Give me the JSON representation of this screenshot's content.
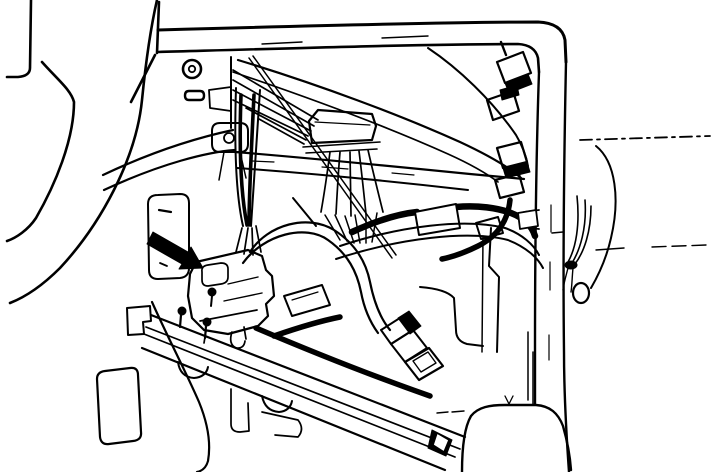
{
  "figure": {
    "title": "Under-dash wiring harness and connector location illustration (service-manual line art); black arrow indicates the main connector beside the lower dash opening",
    "type": "technical-line-illustration",
    "background": "#ffffff",
    "ink": "#000000",
    "arrow_color": "#000000",
    "elements": [
      {
        "n": "dash-top-bar-upper-edge",
        "t": "p",
        "d": "M158,30 C300,26 450,22 538,22 Q562,23 565,40 L566,62",
        "w": 3
      },
      {
        "n": "dash-top-bar-lower-edge",
        "t": "p",
        "d": "M158,52 C300,48 430,44 518,44 Q535,45 538,58 L539,72",
        "w": 2.6
      },
      {
        "n": "dash-top-bar-left-post",
        "t": "p",
        "d": "M159,2 L157,53 M155,55 L131,102",
        "w": 2.6
      },
      {
        "n": "dash-top-bar-tick-1",
        "t": "p",
        "d": "M262,44 L302,42",
        "w": 1.4
      },
      {
        "n": "dash-top-bar-tick-2",
        "t": "p",
        "d": "M382,38 L428,36",
        "w": 1.4
      },
      {
        "n": "a-pillar-left-edge",
        "t": "p",
        "d": "M539,72 C536,160 535,260 535,348 L535,404",
        "w": 2.4
      },
      {
        "n": "a-pillar-right-edge",
        "t": "p",
        "d": "M566,62 C564,160 563,270 564,352 C564,395 566,430 569,472",
        "w": 2.4
      },
      {
        "n": "a-pillar-dash-marks",
        "t": "p",
        "d": "M551,205 L551,232 M550,262 L550,290 M549,335 L549,360",
        "w": 1.2
      },
      {
        "n": "pillar-step-bracket",
        "t": "p",
        "d": "M539,210 L524,212 L523,227 L539,229",
        "w": 1.8
      },
      {
        "n": "door-sill-line",
        "t": "p",
        "d": "M580,140 L710,136",
        "w": 1.8,
        "da": "12 5 3 5"
      },
      {
        "n": "seat-contour-line-short",
        "t": "p",
        "d": "M596,250 L624,248",
        "w": 1.4
      },
      {
        "n": "seat-contour-line-long",
        "t": "p",
        "d": "M652,247 L706,245",
        "w": 1.4,
        "da": "14 6"
      },
      {
        "n": "door-panel-curve",
        "t": "p",
        "d": "M596,146 C616,162 620,200 611,238 C606,260 598,276 591,288",
        "w": 2
      },
      {
        "n": "floor-hump-contour",
        "t": "p",
        "d": "M462,472 C462,448 464,428 471,416 C478,407 490,405 505,405 L536,405 C550,406 558,413 563,426 C567,440 570,456 571,470",
        "w": 2.4
      },
      {
        "n": "floor-hump-dash-marks",
        "t": "p",
        "d": "M437,413 L448,412 M452,412 L464,411",
        "w": 1.4
      },
      {
        "n": "heater-lower-vertical",
        "t": "p",
        "d": "M533,352 L533,404 M528,332 L528,400",
        "w": 1.5
      },
      {
        "n": "floor-vee-mark",
        "t": "p",
        "d": "M505,396 L509,404 L513,396",
        "w": 1.3
      },
      {
        "n": "steering-wheel-rim",
        "t": "p",
        "d": "M31,0 L30,68 Q30,76 18,77 L7,77",
        "w": 2.6
      },
      {
        "n": "steering-column-front-edge",
        "t": "p",
        "d": "M42,62 C58,80 71,90 74,102 C74,140 55,185 36,218 C28,230 16,238 7,241",
        "w": 2.6
      },
      {
        "n": "steering-column-rear-edge",
        "t": "p",
        "d": "M157,0 C149,35 145,70 142,100 C136,160 100,225 60,268 C45,283 28,296 10,303",
        "w": 2.6
      },
      {
        "n": "panel-screw-outer",
        "t": "c",
        "cx": 192,
        "cy": 69,
        "r": 9,
        "w": 2.6
      },
      {
        "n": "panel-screw-inner",
        "t": "c",
        "cx": 192,
        "cy": 69,
        "r": 3.2,
        "w": 1.8
      },
      {
        "n": "panel-slot",
        "t": "p",
        "d": "M189,91 L200,91 Q204,91 204,95.5 Q204,100 200,100 L189,100 Q185,100 185,95.5 Q185,91 189,91 Z",
        "w": 2.4
      },
      {
        "n": "panel-edge-vertical",
        "t": "p",
        "d": "M231,57 L231,128",
        "w": 2
      },
      {
        "n": "panel-bracket-tab",
        "t": "p",
        "d": "M231,87 L209,90 L210,108 L231,111",
        "w": 1.8
      },
      {
        "n": "panel-mount-boss",
        "t": "p",
        "d": "M220,123 L240,123 Q248,123 248,131 L248,144 Q248,152 240,152 L220,152 Q212,152 212,144 L212,131 Q212,123 220,123 Z",
        "w": 2
      },
      {
        "n": "panel-mount-hole",
        "t": "c",
        "cx": 229,
        "cy": 138,
        "r": 5,
        "w": 1.8
      },
      {
        "n": "panel-mount-stems",
        "t": "p",
        "d": "M224,152 L219,180 M240,152 L246,178",
        "w": 1.5
      },
      {
        "n": "column-support-band-upper",
        "t": "p",
        "d": "M103,175 C160,148 205,136 233,130",
        "w": 2.2
      },
      {
        "n": "column-support-band-lower",
        "t": "p",
        "d": "M104,190 C162,163 208,152 235,150",
        "w": 2.2
      },
      {
        "n": "crossmember-top-edge",
        "t": "p",
        "d": "M235,152 C310,158 390,166 470,174 L524,179",
        "w": 2.2
      },
      {
        "n": "crossmember-bottom-edge",
        "t": "p",
        "d": "M237,168 C305,173 390,181 468,190",
        "w": 2
      },
      {
        "n": "crossmember-dash-marks",
        "t": "p",
        "d": "M252,161 L274,162 M322,167 L348,169 M392,173 L414,175",
        "w": 1.2
      },
      {
        "n": "wire-fan-behind-panel",
        "t": "p",
        "d": "M233,70 L318,120 M233,80 L314,126 M233,90 L311,131 M233,100 L308,136 M246,108 L306,140 M259,119 L304,144",
        "w": 1.7
      },
      {
        "n": "harness-branch-upper-right-a",
        "t": "p",
        "d": "M238,60 C320,85 400,115 460,142 C490,156 510,168 521,178",
        "w": 2.2
      },
      {
        "n": "harness-branch-upper-right-b",
        "t": "p",
        "d": "M233,72 C310,98 390,128 448,154 C468,163 486,173 498,182",
        "w": 1.7
      },
      {
        "n": "antenna-rod",
        "t": "p",
        "d": "M249,58 L392,258 M253,56 L396,255",
        "w": 1.5
      },
      {
        "n": "glovebox-inner-curve",
        "t": "p",
        "d": "M428,48 C458,68 492,100 516,135 C522,145 526,155 528,166",
        "w": 2
      },
      {
        "n": "panel-lower-diagonal",
        "t": "p",
        "d": "M293,198 L316,226",
        "w": 2
      },
      {
        "n": "junction-connector-body",
        "t": "p",
        "d": "M309,121 L318,110 L372,114 L376,126 L372,140 L312,143 Z",
        "w": 2.2
      },
      {
        "n": "junction-connector-ridge",
        "t": "p",
        "d": "M315,122 L370,125",
        "w": 1.2
      },
      {
        "n": "junction-connector-flange",
        "t": "p",
        "d": "M303,147 L380,142 M306,153 L377,149",
        "w": 1.6
      },
      {
        "n": "junction-wire-fan",
        "t": "p",
        "d": "M330,152 C327,175 324,195 321,212 M340,152 C338,176 337,196 336,214 M350,152 L351,216 M359,151 C362,175 364,195 366,214 M368,150 C373,172 378,192 383,212",
        "w": 1.7
      },
      {
        "n": "junction-wire-strands",
        "t": "p",
        "d": "M325,215 L340,240 M335,215 L347,241 M345,216 L354,243 M355,215 L360,243 M366,214 L366,243 M377,213 L372,242",
        "w": 1.5
      },
      {
        "n": "harness-tape-arc-left",
        "t": "p",
        "d": "M352,232 C378,220 398,214 417,212",
        "w": 6.5
      },
      {
        "n": "harness-tape-arc-right",
        "t": "p",
        "d": "M456,207 C478,205 498,208 511,213 C524,218 532,226 535,236",
        "w": 6.5
      },
      {
        "n": "harness-tape-patch",
        "t": "p",
        "d": "M415,212 L456,204 L460,228 L419,235 Z",
        "w": 2,
        "f": "#ffffff"
      },
      {
        "n": "harness-tape-end-clip",
        "t": "p",
        "d": "M518,213 L536,210 L538,226 L520,229 Z",
        "w": 1.8,
        "f": "#ffffff"
      },
      {
        "n": "harness-band-upper-edge",
        "t": "p",
        "d": "M340,246 C400,226 465,218 505,228 C522,234 534,245 539,255",
        "w": 2
      },
      {
        "n": "harness-band-lower-edge",
        "t": "p",
        "d": "M336,259 C400,238 468,230 508,240 C526,247 538,258 543,268",
        "w": 2
      },
      {
        "n": "harness-loop-outer",
        "t": "p",
        "d": "M250,252 C268,224 308,214 334,230 C356,244 366,262 370,282 C374,302 380,318 390,330",
        "w": 2.2
      },
      {
        "n": "harness-loop-inner",
        "t": "p",
        "d": "M243,263 C264,234 306,224 328,240 C348,254 357,272 361,292 C364,308 370,322 378,333",
        "w": 2.2
      },
      {
        "n": "hanging-connector-collar",
        "t": "p",
        "d": "M398,318 L409,311 L421,326 L410,334 Z",
        "w": 1,
        "f": "#000000"
      },
      {
        "n": "hanging-connector-band-1",
        "t": "p",
        "d": "M381,330 L403,316 L413,330 L391,344 Z",
        "w": 2
      },
      {
        "n": "hanging-connector-band-2",
        "t": "p",
        "d": "M391,344 L413,330 L427,348 L405,362 Z",
        "w": 2
      },
      {
        "n": "hanging-connector-tip-outer",
        "t": "p",
        "d": "M405,362 L429,348 L443,366 L419,380 Z",
        "w": 2.2
      },
      {
        "n": "hanging-connector-tip-inner",
        "t": "p",
        "d": "M413,361 L428,352 L436,363 L421,372 Z",
        "w": 1.4
      },
      {
        "n": "heater-right-edge",
        "t": "p",
        "d": "M491,228 L489,266 L499,277 L497,352",
        "w": 2
      },
      {
        "n": "heater-inner-vertical",
        "t": "p",
        "d": "M483,236 L482,352",
        "w": 1.5
      },
      {
        "n": "heater-corner-panel",
        "t": "p",
        "d": "M420,287 Q446,289 454,298 L456,330 Q456,341 467,344 L483,346",
        "w": 2
      },
      {
        "n": "inline-connector-1",
        "t": "p",
        "d": "M497,62 L523,52 L531,73 L505,83 Z",
        "w": 2.2
      },
      {
        "n": "inline-connector-1-link",
        "t": "p",
        "d": "M505,83 L528,74 L532,84 L509,93 Z",
        "w": 1,
        "f": "#000000"
      },
      {
        "n": "inline-connector-2",
        "t": "p",
        "d": "M487,100 L513,91 L519,111 L493,120 Z",
        "w": 2.2
      },
      {
        "n": "inline-connector-2-link",
        "t": "p",
        "d": "M500,90 L517,85 L519,95 L502,100 Z",
        "w": 1,
        "f": "#000000"
      },
      {
        "n": "inline-connector-3",
        "t": "p",
        "d": "M497,148 L521,142 L527,162 L503,168 Z",
        "w": 2.2
      },
      {
        "n": "inline-connector-3-link",
        "t": "p",
        "d": "M503,168 L527,162 L530,172 L506,178 Z",
        "w": 1,
        "f": "#000000"
      },
      {
        "n": "inline-connector-4",
        "t": "p",
        "d": "M495,180 L519,174 L524,192 L500,198 Z",
        "w": 2.2
      },
      {
        "n": "inline-connector-5",
        "t": "p",
        "d": "M476,223 L498,217 L503,233 L481,239 Z",
        "w": 2
      },
      {
        "n": "inline-connector-neck",
        "t": "p",
        "d": "M506,55 L501,42",
        "w": 2.4
      },
      {
        "n": "chain-harness-tail",
        "t": "p",
        "d": "M510,200 C508,220 498,236 478,246 C464,253 452,257 442,259",
        "w": 5.5
      },
      {
        "n": "pillar-wire-strands",
        "t": "p",
        "d": "M577,196 C580,225 576,248 568,262 M585,200 C587,228 580,250 572,263 M591,206 C591,232 584,252 575,264",
        "w": 1.6
      },
      {
        "n": "pillar-wire-knot",
        "t": "e",
        "cx": 571,
        "cy": 265,
        "rx": 6,
        "ry": 4,
        "w": 1,
        "f": "#000000"
      },
      {
        "n": "pillar-wire-tails",
        "t": "p",
        "d": "M568,268 C566,276 564,282 563,290 M573,268 C572,278 572,286 571,292",
        "w": 1.4
      },
      {
        "n": "pillar-wire-loop",
        "t": "e",
        "cx": 581,
        "cy": 293,
        "rx": 8,
        "ry": 10,
        "w": 2.2
      },
      {
        "n": "pillar-wire-tick",
        "t": "p",
        "d": "M552,233 L563,232",
        "w": 1.5
      },
      {
        "n": "lower-dash-opening",
        "t": "p",
        "d": "M158,195 L180,194 Q189,194 189,203 L189,268 Q189,277 180,278 L158,279 Q149,279 149,270 L148,204 Q148,195 158,195 Z",
        "w": 2
      },
      {
        "n": "opening-mark-1",
        "t": "p",
        "d": "M159,210 L171,212",
        "w": 2.2
      },
      {
        "n": "opening-mark-2",
        "t": "p",
        "d": "M160,263 L167,266",
        "w": 1.8
      },
      {
        "n": "pointer-arrow",
        "t": "p",
        "d": "M153,232 L188,252 L191,247 L203,268 L179,269 L182,264 L147,244 Z",
        "w": 1,
        "f": "#000000"
      },
      {
        "n": "main-bundle-left-edge",
        "t": "p",
        "d": "M236,88 C234,150 236,195 243,226",
        "w": 2
      },
      {
        "n": "main-bundle-right-edge",
        "t": "p",
        "d": "M260,90 C256,155 253,198 251,226",
        "w": 2
      },
      {
        "n": "main-bundle-core",
        "t": "p",
        "d": "M241,95 C239,150 241,195 247,225 M254,95 C251,155 249,198 249,225",
        "w": 3.6
      },
      {
        "n": "main-bundle-strands",
        "t": "p",
        "d": "M242,228 L236,252 M248,228 L244,254 M252,228 L253,255 M256,226 L261,252",
        "w": 1.7
      },
      {
        "n": "main-connector-outline",
        "t": "p",
        "d": "M196,262 L248,250 L262,256 L266,270 L272,276 L274,296 L266,304 L268,316 L258,326 L228,334 L204,330 L192,318 L188,296 L190,274 Z",
        "w": 2.2
      },
      {
        "n": "main-connector-latch",
        "t": "p",
        "d": "M202,272 Q201,266 208,265 L221,263 Q228,263 228,269 L228,277 Q228,283 221,284 L208,286 Q202,286 202,280 Z",
        "w": 1.7
      },
      {
        "n": "main-connector-pin",
        "t": "c",
        "cx": 212,
        "cy": 292,
        "r": 4,
        "w": 1,
        "f": "#000000"
      },
      {
        "n": "main-connector-pin-stem",
        "t": "p",
        "d": "M212,296 L211,306",
        "w": 2
      },
      {
        "n": "main-connector-ridge-1",
        "t": "p",
        "d": "M228,284 L258,277",
        "w": 1.4
      },
      {
        "n": "main-connector-ridge-2",
        "t": "p",
        "d": "M224,301 L262,293",
        "w": 1.4
      },
      {
        "n": "main-connector-flange",
        "t": "p",
        "d": "M200,321 L257,310",
        "w": 1.7
      },
      {
        "n": "main-connector-tabs",
        "t": "p",
        "d": "M206,331 L204,343 M244,327 L246,339",
        "w": 1.7
      },
      {
        "n": "side-connector-body",
        "t": "p",
        "d": "M284,296 L322,285 L330,305 L292,316 Z",
        "w": 2
      },
      {
        "n": "side-connector-ridge",
        "t": "p",
        "d": "M292,300 L318,292",
        "w": 1.2
      },
      {
        "n": "rail-harness-strip",
        "t": "p",
        "d": "M274,336 C300,327 320,321 340,317",
        "w": 5.5
      },
      {
        "n": "rail-harness-strip-long",
        "t": "p",
        "d": "M256,328 C310,351 370,375 430,396",
        "w": 5.5
      },
      {
        "n": "rail-end-cap",
        "t": "p",
        "d": "M127,308 L150,306 L151,321 L143,322 L144,334 L128,335 Z",
        "w": 2
      },
      {
        "n": "rail-top-edge",
        "t": "p",
        "d": "M151,315 L465,437",
        "w": 2.2
      },
      {
        "n": "rail-stripe-1",
        "t": "p",
        "d": "M146,327 L460,449",
        "w": 1.7
      },
      {
        "n": "rail-stripe-2",
        "t": "p",
        "d": "M144,334 L455,457",
        "w": 1.7
      },
      {
        "n": "rail-bottom-edge",
        "t": "p",
        "d": "M142,348 L445,470",
        "w": 2.2
      },
      {
        "n": "rail-scallop-1",
        "t": "p",
        "d": "M178,362 Q180,377 194,378 Q206,377 208,367",
        "w": 2
      },
      {
        "n": "rail-scallop-2",
        "t": "p",
        "d": "M262,396 Q265,411 279,412 Q290,411 292,401",
        "w": 2
      },
      {
        "n": "rail-stud-1",
        "t": "c",
        "cx": 182,
        "cy": 311,
        "r": 4,
        "w": 1,
        "f": "#000000"
      },
      {
        "n": "rail-stud-1-stem",
        "t": "p",
        "d": "M181,315 L180,327",
        "w": 2.2
      },
      {
        "n": "rail-stud-2",
        "t": "c",
        "cx": 207,
        "cy": 322,
        "r": 4,
        "w": 1,
        "f": "#000000"
      },
      {
        "n": "rail-stud-2-stem",
        "t": "p",
        "d": "M206,326 L205,338",
        "w": 2.2
      },
      {
        "n": "rail-hook",
        "t": "p",
        "d": "M232,332 Q228,344 236,348 Q244,349 245,341",
        "w": 1.7
      },
      {
        "n": "rail-end-contents-dark",
        "t": "p",
        "d": "M432,430 L452,440 L446,456 L428,448 Z",
        "w": 1,
        "f": "#000000"
      },
      {
        "n": "rail-end-contents-clip",
        "t": "p",
        "d": "M437,433 L449,440 L444,452 L433,445 Z",
        "w": 1.5,
        "f": "#ffffff"
      },
      {
        "n": "kick-panel-contour",
        "t": "p",
        "d": "M152,302 C168,338 186,372 199,402 C208,424 211,444 208,461 C206,468 202,471 197,472",
        "w": 2.2
      },
      {
        "n": "accelerator-pedal",
        "t": "p",
        "d": "M105,371 L130,368 Q138,367 138,375 L141,432 Q142,440 133,441 L109,444 Q101,445 100,437 L97,379 Q97,372 105,371 Z",
        "w": 2.2
      },
      {
        "n": "floor-bracket-1",
        "t": "p",
        "d": "M231,389 L231,424 Q231,432 240,432 L249,431 L248,403",
        "w": 1.7
      },
      {
        "n": "floor-bracket-2",
        "t": "p",
        "d": "M262,412 L298,420 Q305,429 298,437 L275,435",
        "w": 1.7
      }
    ]
  }
}
